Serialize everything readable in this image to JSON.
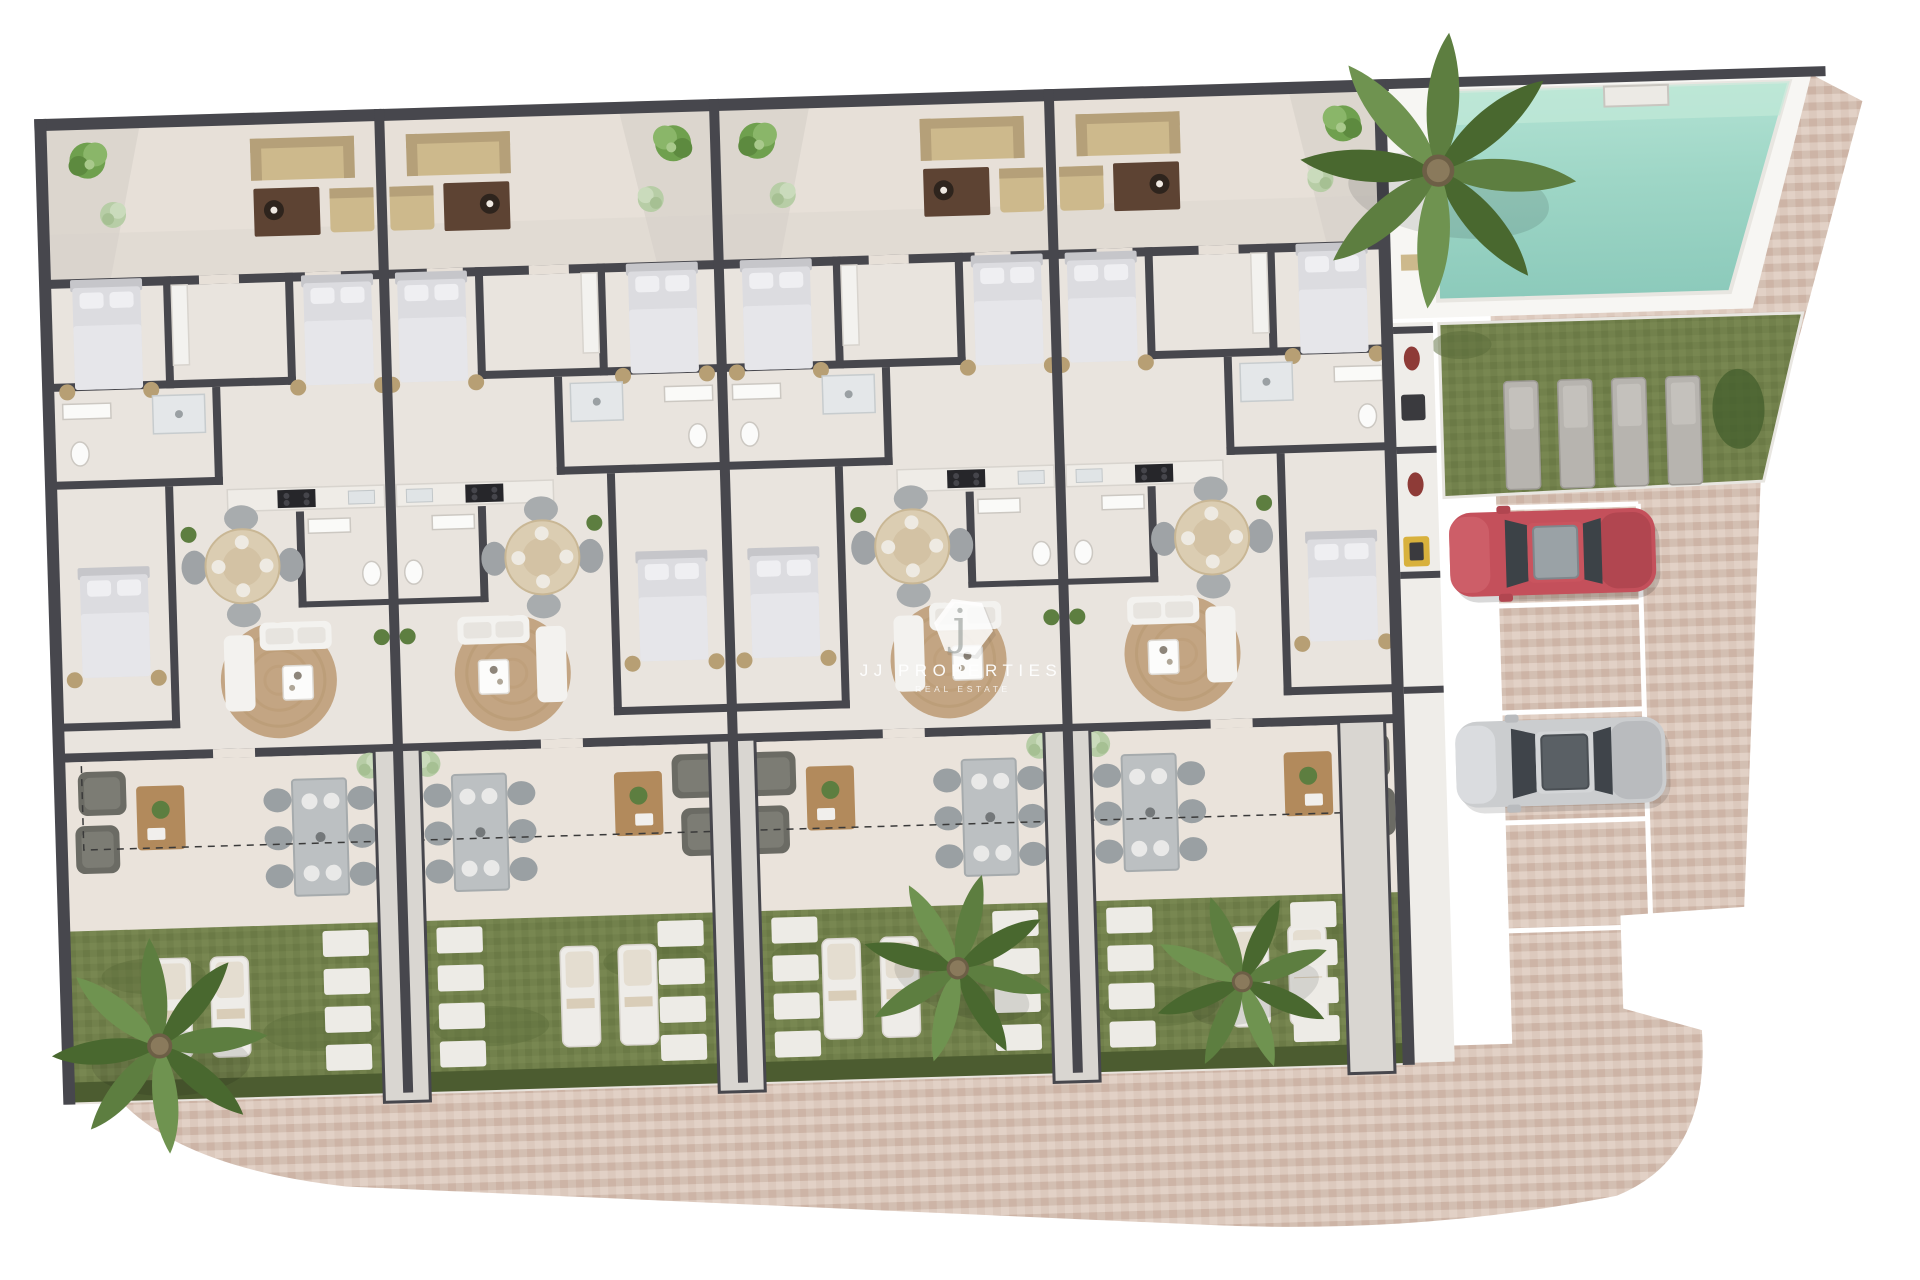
{
  "page": {
    "type": "3D rendered ground-floor site plan of a residential complex",
    "background": "#ffffff"
  },
  "watermark": {
    "logo_letter": "j",
    "brand_name": "JJ PROPERTIES",
    "tagline": "REAL ESTATE"
  },
  "palette": {
    "wall": "#47474d",
    "floor": "#e9e4de",
    "terrace_floor": "#e7e0d8",
    "grass": "#72814c",
    "hedge": "#4c5c30",
    "pool_water": "#9ed6c6",
    "pool_water_light": "#bde7d9",
    "pool_deck": "#f7f6f3",
    "paver": "#d8c5b9",
    "paver_dark": "#cdb4a6",
    "paver_light": "#e2d1c6",
    "entry_path": "#d9d6d1",
    "stepping_stone": "#edebe6",
    "car_red": "#c4505b",
    "car_silver": "#cbcdcf",
    "parking_line": "#ffffff",
    "rug": "#c3a583",
    "outdoor_sofa": "#cdb98c",
    "coffee_table": "#5d4333",
    "white_furniture": "#f3f2ef",
    "bed": "#dcdce0",
    "lounger_white": "#eeece8",
    "lounger_gray": "#b7b4af",
    "palm_green": "#5d7e40",
    "bush_green": "#6fa04e",
    "dashed_boundary": "#3a3a3a"
  },
  "site": {
    "unit_modules": 4,
    "entry_paths": 4,
    "swimming_pools": 1,
    "pool_loungers": 4,
    "garden_loungers_total": 8,
    "garden_loungers_per_unit": 2,
    "palm_trees": 4,
    "parking": {
      "marked_stalls": 5,
      "cars": [
        {
          "color_name": "red",
          "hex": "#c4505b"
        },
        {
          "color_name": "silver",
          "hex": "#cbcdcf"
        }
      ]
    },
    "landscape_features": [
      "swimming pool",
      "pool lawn",
      "private gardens",
      "hedges",
      "paver walkway",
      "stepping stones"
    ]
  }
}
